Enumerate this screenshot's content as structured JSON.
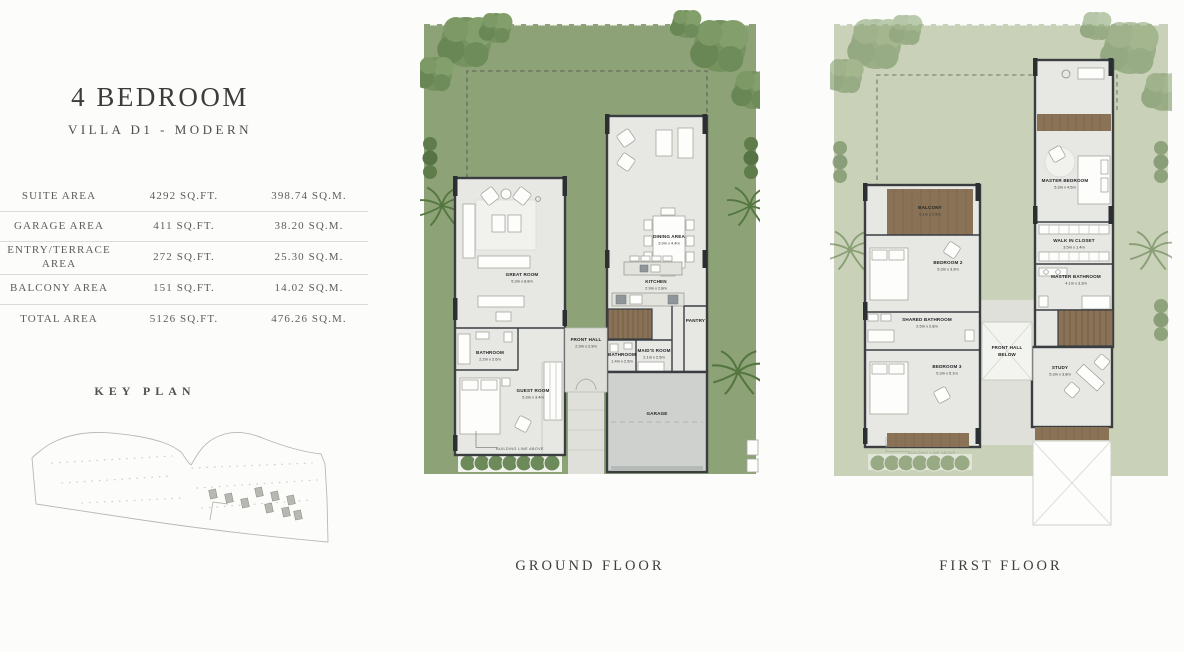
{
  "header": {
    "title": "4 BEDROOM",
    "subtitle": "VILLA D1 - MODERN"
  },
  "area_table": {
    "rows": [
      {
        "label": "SUITE AREA",
        "sqft": "4292 SQ.FT.",
        "sqm": "398.74 SQ.M."
      },
      {
        "label": "GARAGE AREA",
        "sqft": "411 SQ.FT.",
        "sqm": "38.20 SQ.M."
      },
      {
        "label": "ENTRY/TERRACE AREA",
        "sqft": "272 SQ.FT.",
        "sqm": "25.30 SQ.M."
      },
      {
        "label": "BALCONY AREA",
        "sqft": "151 SQ.FT.",
        "sqm": "14.02 SQ.M."
      },
      {
        "label": "TOTAL AREA",
        "sqft": "5126 SQ.FT.",
        "sqm": "476.26 SQ.M."
      }
    ]
  },
  "key_plan": {
    "title": "KEY PLAN"
  },
  "ground_floor": {
    "caption": "GROUND FLOOR",
    "building_line_label": "BUILDING LINE ABOVE",
    "rooms": {
      "great_room": {
        "name": "GREAT ROOM",
        "dims": "5.3m x 8.8m"
      },
      "dining_area": {
        "name": "DINING AREA",
        "dims": "3.9m x 4.4m"
      },
      "kitchen": {
        "name": "KITCHEN",
        "dims": "2.9m x 2.8m"
      },
      "pantry": {
        "name": "PANTRY"
      },
      "front_hall": {
        "name": "FRONT HALL",
        "dims": "2.9m x 2.9m"
      },
      "maids_room": {
        "name": "MAID'S ROOM",
        "dims": "2.1m x 2.5m"
      },
      "bathroom": {
        "name": "BATHROOM",
        "dims": "1.4m x 2.5m"
      },
      "guest_bathroom": {
        "name": "BATHROOM",
        "dims": "2.2m x 2.6m"
      },
      "guest_room": {
        "name": "GUEST ROOM",
        "dims": "5.3m x 3.4m"
      },
      "garage": {
        "name": "GARAGE"
      }
    }
  },
  "first_floor": {
    "caption": "FIRST FLOOR",
    "building_line_label": "BUILDING LINE ABOVE",
    "rooms": {
      "master_bedroom": {
        "name": "MASTER BEDROOM",
        "dims": "5.3m x 4.5m"
      },
      "balcony": {
        "name": "BALCONY",
        "dims": "5.1m x 2.5m"
      },
      "bedroom_2": {
        "name": "BEDROOM 2",
        "dims": "5.3m x 3.9m"
      },
      "walk_in_closet": {
        "name": "WALK IN CLOSET",
        "dims": "3.5m x 1.4m"
      },
      "master_bathroom": {
        "name": "MASTER BATHROOM",
        "dims": "4.1m x 3.3m"
      },
      "shared_bathroom": {
        "name": "SHARED BATHROOM",
        "dims": "2.5m x 2.8m"
      },
      "bedroom_3": {
        "name": "BEDROOM 3",
        "dims": "5.3m x 5.1m"
      },
      "front_hall_below": {
        "line1": "FRONT HALL",
        "line2": "BELOW"
      },
      "study": {
        "name": "STUDY",
        "dims": "5.3m x 3.8m"
      }
    }
  },
  "colors": {
    "bg": "#fcfcfa",
    "ink": "#3c3c3c",
    "muted": "#5d5d5b",
    "rule": "#dcdcd7",
    "lawn": "#8da277",
    "lawn-faded": "#c9d1b9",
    "slab": "#e7e8e4",
    "garage-slab": "#ced1ce",
    "wall": "#3a3e41",
    "wood": "#8a7257",
    "path": "#dfe0da"
  }
}
